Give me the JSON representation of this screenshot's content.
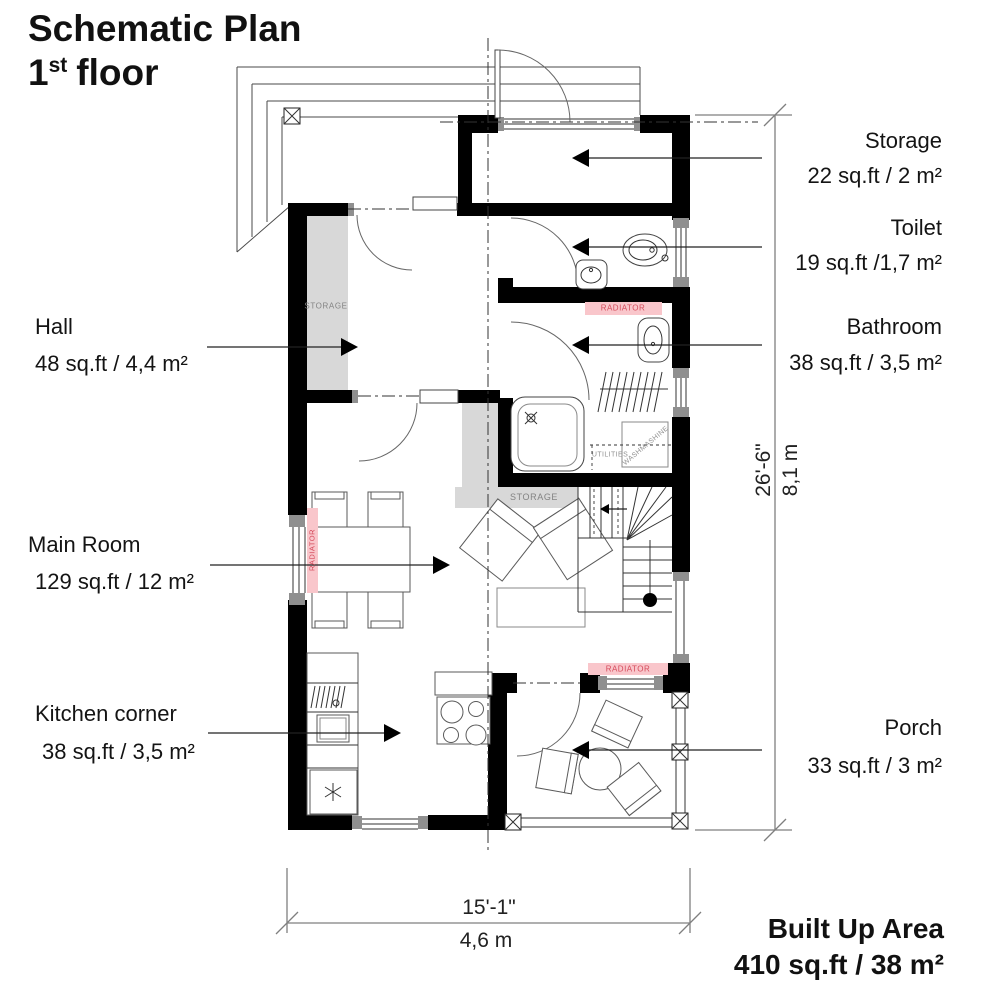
{
  "title": {
    "line1": "Schematic Plan",
    "floor_number": "1",
    "floor_ordinal": "st",
    "floor_word": "floor"
  },
  "rooms": {
    "hall": {
      "name": "Hall",
      "area": "48 sq.ft / 4,4 m²"
    },
    "main_room": {
      "name": "Main Room",
      "area": "129 sq.ft / 12 m²"
    },
    "kitchen": {
      "name": "Kitchen corner",
      "area": "38 sq.ft / 3,5 m²"
    },
    "storage": {
      "name": "Storage",
      "area": "22 sq.ft / 2 m²"
    },
    "toilet": {
      "name": "Toilet",
      "area": "19 sq.ft /1,7 m²"
    },
    "bathroom": {
      "name": "Bathroom",
      "area": "38 sq.ft / 3,5 m²"
    },
    "porch": {
      "name": "Porch",
      "area": "33 sq.ft / 3 m²"
    }
  },
  "dimensions": {
    "height_imperial": "26'-6\"",
    "height_metric": "8,1 m",
    "width_imperial": "15'-1\"",
    "width_metric": "4,6 m"
  },
  "built_up_area": {
    "label": "Built Up Area",
    "value": "410 sq.ft / 38 m²"
  },
  "plan_annotations": {
    "storage_hall": "STORAGE",
    "storage_main": "STORAGE",
    "radiator_window": "RADIATOR",
    "radiator_bathroom": "RADIATOR",
    "radiator_porch": "RADIATOR",
    "utilities": "UTILITIES",
    "washing_machine": "WASHMASHINE"
  },
  "colors": {
    "wall": "#000000",
    "radiator_bg": "#f9c6cb",
    "radiator_text": "#d4495a",
    "storage_fill": "#d8d8d8",
    "dim_line": "#7f7f7f"
  }
}
